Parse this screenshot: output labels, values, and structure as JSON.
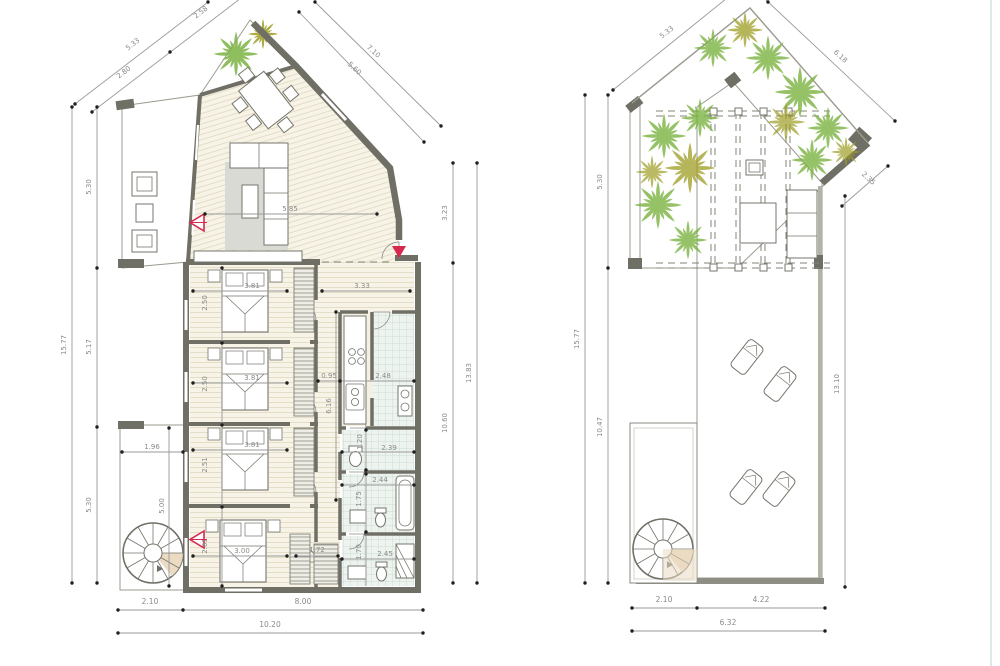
{
  "sheet": {
    "title": "floor-plan-sheet",
    "colors": {
      "wall": "#6f6f66",
      "accent_red": "#d5294d",
      "tree_green": "#7cb342",
      "tree_olive": "#9e9d24",
      "wood": "#f6f2e4",
      "tile": "#fbf8f0",
      "bath_tile": "#ecf2ec"
    }
  },
  "lp": {
    "nw_total": "5.33",
    "nw_a": "2.80",
    "nw_b": "2.58",
    "ne_outer": "7.10",
    "ne_inner": "5.60",
    "w_total": "15.77",
    "w_a": "5.30",
    "w_b": "5.17",
    "w_c": "5.30",
    "e_total": "13.83",
    "e_a": "3.23",
    "e_b": "10.60",
    "s_a": "2.10",
    "s_b": "8.00",
    "s_total": "10.20",
    "living": "5.85",
    "hall": "3.33",
    "bed1_w": "3.81",
    "bed1_d": "2.50",
    "bed2_w": "3.81",
    "bed2_d": "2.50",
    "bed3_w": "3.81",
    "bed3_d": "2.51",
    "master_w": "3.00",
    "master_d": "2.61",
    "corridor_w": "0.95",
    "corridor_l": "6.16",
    "kitchen_w": "2.48",
    "wc_d": "1.20",
    "wc_w": "2.39",
    "bath1_w": "2.44",
    "bath1_d": "1.75",
    "bath2_w": "2.45",
    "bath2_d": "1.70",
    "terrace_w": "1.96",
    "terrace_d": "5.00",
    "wardrobe_w": "1.72"
  },
  "rp": {
    "nw": "5.33",
    "ne": "6.18",
    "e_slant": "2.35",
    "w_total": "15.77",
    "w_a": "5.30",
    "w_b": "10.47",
    "e_total": "13.10",
    "s_a": "2.10",
    "s_b": "4.22",
    "s_total": "6.32"
  }
}
